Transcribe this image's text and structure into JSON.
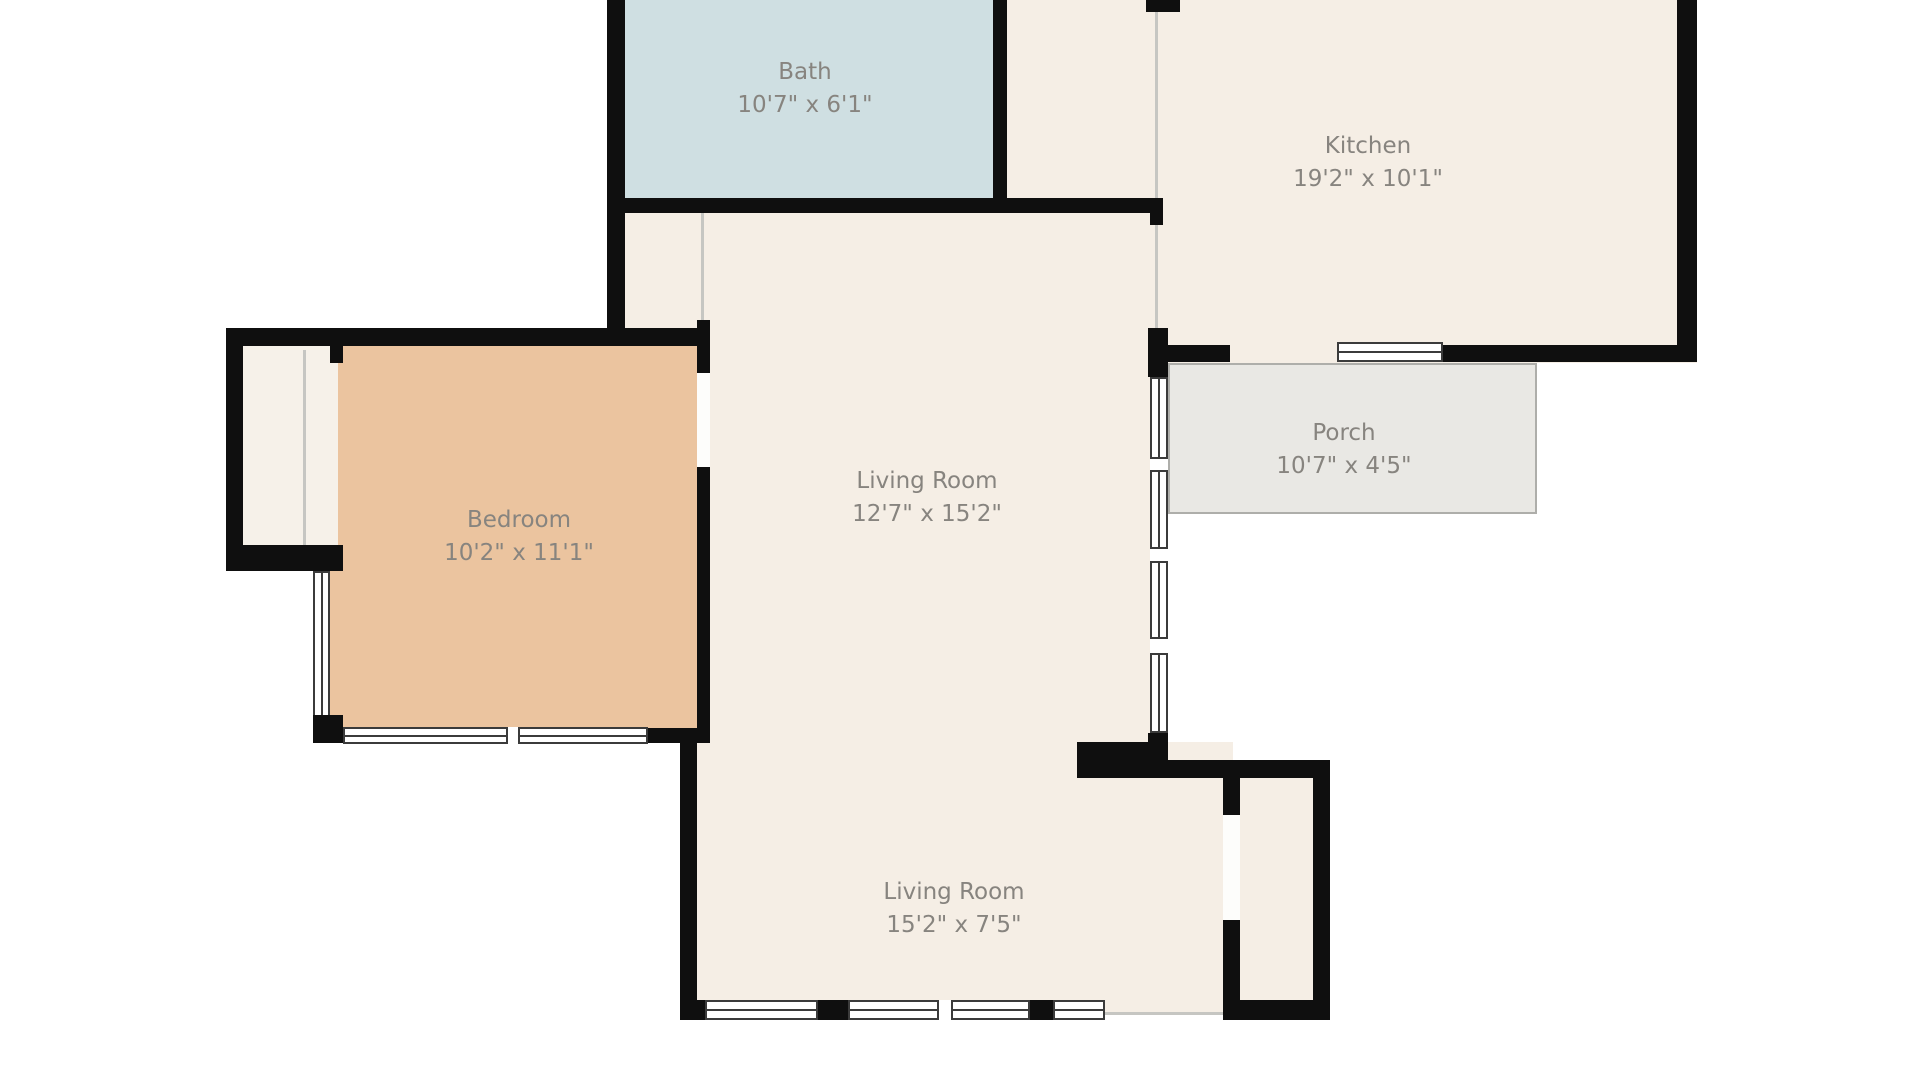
{
  "plan_type": "floor-plan",
  "rooms": [
    {
      "name": "Bath",
      "dimensions": "10'7\" x 6'1\""
    },
    {
      "name": "Kitchen",
      "dimensions": "19'2\" x 10'1\""
    },
    {
      "name": "Bedroom",
      "dimensions": "10'2\" x 11'1\""
    },
    {
      "name": "Living Room",
      "dimensions": "12'7\" x 15'2\""
    },
    {
      "name": "Porch",
      "dimensions": "10'7\" x 4'5\""
    },
    {
      "name": "Living Room",
      "dimensions": "15'2\" x 7'5\""
    }
  ],
  "colors": {
    "wall": "#0f0f0f",
    "floor_main": "#f5eee5",
    "floor_bath": "#cfdfe2",
    "floor_bedroom": "#ebc49f",
    "floor_porch": "#e9e8e4",
    "window_frame": "#3b3b3b",
    "label_text": "#87847f",
    "background": "#ffffff"
  }
}
